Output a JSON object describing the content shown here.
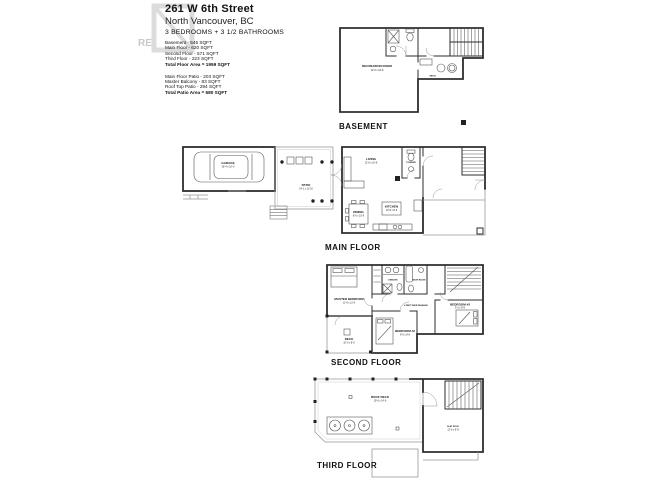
{
  "header": {
    "address": "261 W 6th Street",
    "city": "North Vancouver, BC",
    "rooms_summary": "3 BEDROOMS + 3 1/2 BATHROOMS",
    "floor_areas": [
      "Basement - 545 SQFT",
      "Main Floor - 620 SQFT",
      "Second Floor - 571 SQFT",
      "Third Floor - 223 SQFT"
    ],
    "floor_total": "Total Floor Area = 1959 SQFT",
    "patio_areas": [
      "Main Floor Patio  - 203 SQFT",
      "Master Balcony - 83 SQFT",
      "Roof Top Patio  - 294 SQFT"
    ],
    "patio_total": "Total Patio Area = 580 SQFT",
    "watermark_text": "RE"
  },
  "floors": {
    "basement": {
      "name": "BASEMENT",
      "rooms": {
        "recreation": "RECREATION ROOM",
        "recreation_dims": "12'-6 x 19'-8",
        "mech": "MECH."
      }
    },
    "main": {
      "name": "MAIN FLOOR",
      "rooms": {
        "garage": "GARAGE",
        "garage_dims": "18'-4 x 10'-0",
        "patio": "PATIO",
        "patio_dims": "14'-1 x 11'-10",
        "living": "LIVING",
        "living_dims": "12'-6 x 10'-8",
        "powder": "POWDER",
        "dining": "DINING",
        "dining_dims": "8'-0 x 10'-6",
        "kitchen": "KITCHEN",
        "kitchen_dims": "10'-8 x 8'-6"
      }
    },
    "second": {
      "name": "SECOND FLOOR",
      "rooms": {
        "master": "MASTER BEDROOM",
        "master_dims": "11'-6 x 11'-0",
        "ensuite": "ENSUITE",
        "bath": "BATH ROOM",
        "passage": "4 FEET WIDE PASSAGE",
        "bedroom2": "BEDROOM #2",
        "bedroom2_dims": "9'-0 x 8'-6",
        "bedroom3": "BEDROOM #3",
        "bedroom3_dims": "9'-2 x 8'-8",
        "deck": "DECK",
        "deck_dims": "10'-0 x 8'-0"
      }
    },
    "third": {
      "name": "THIRD FLOOR",
      "rooms": {
        "roof_deck": "ROOF DECK",
        "roof_deck_dims": "19'-0 x 14'-6",
        "flat_roof": "FLAT ROOF",
        "flat_roof_dims": "12'-6 x 9'-8"
      }
    }
  }
}
